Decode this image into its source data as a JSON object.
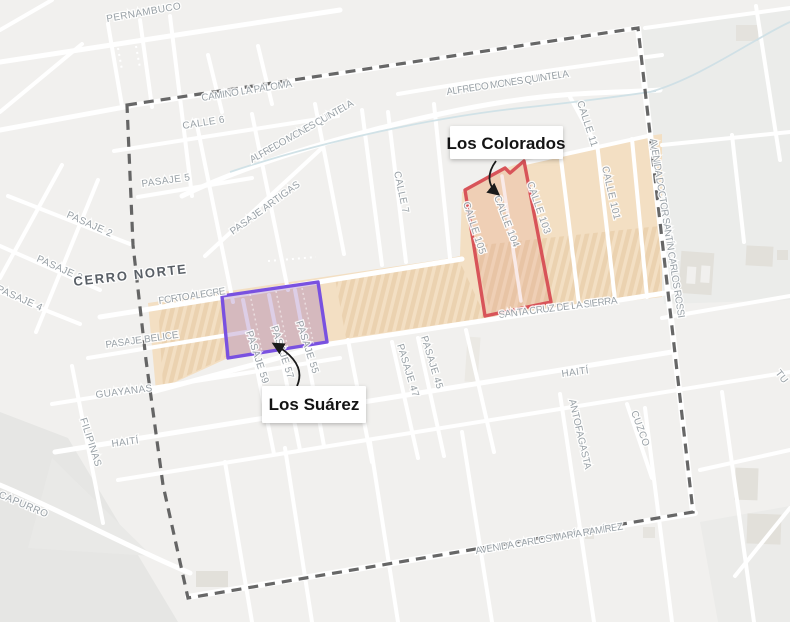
{
  "area": {
    "cerro_norte": "CERRO NORTE"
  },
  "districts": {
    "los_colorados": {
      "label": "Los Colorados",
      "outline_color": "#d85459"
    },
    "los_suarez": {
      "label": "Los Suárez",
      "outline_color": "#7951e0"
    }
  },
  "streets": {
    "pernambuco": "PERNAMBUCO",
    "camino_la_paloma": "CAMINO LA PALOMA",
    "alfredo_mones_quintela": "ALFREDO MONES QUINTELA",
    "calle_6": "CALLE 6",
    "pasaje_5": "PASAJE 5",
    "pasaje_2": "PASAJE 2",
    "pasaje_3": "PASAJE 3",
    "pasaje_4": "PASAJE 4",
    "pasaje_artigas": "PASAJE ARTIGAS",
    "calle_7": "CALLE 7",
    "calle_11": "CALLE 11",
    "calle_101": "CALLE 101",
    "calle_103": "CALLE 103",
    "calle_104": "CALLE 104",
    "calle_105": "CALLE 105",
    "avenida_doctor_santin_carlos_rossi": "AVENIDA DOCTOR SANTÍN CARLOS ROSSI",
    "porto_alegre": "PORTO ALEGRE",
    "pasaje_belice": "PASAJE BELICE",
    "santa_cruz_de_la_sierra": "SANTA CRUZ DE LA SIERRA",
    "pasaje_45": "PASAJE 45",
    "pasaje_47": "PASAJE 47",
    "pasaje_55": "PASAJE 55",
    "pasaje_57": "PASAJE 57",
    "pasaje_59": "PASAJE 59",
    "guayanas": "GUAYANAS",
    "filipinas": "FILIPINAS",
    "haiti": "HAITÍ",
    "capurro": "CAPURRO",
    "antofagasta": "ANTOFAGASTA",
    "cuzco": "CUZCO",
    "avenida_carlos_maria_ramirez": "AVENIDA CARLOS MARÍA RAMÍREZ",
    "tu_partial": "TU"
  },
  "colors": {
    "background": "#f1f0ee",
    "road": "#ffffff",
    "district_band_fill": "#f3dfc3",
    "building_strip": "#e9ceab",
    "boundary_dash": "#4c4c4c",
    "label_gray": "#98a0a6",
    "water": "#cfe0e6",
    "colorados_outline": "#d85459",
    "suarez_outline": "#7951e0"
  }
}
